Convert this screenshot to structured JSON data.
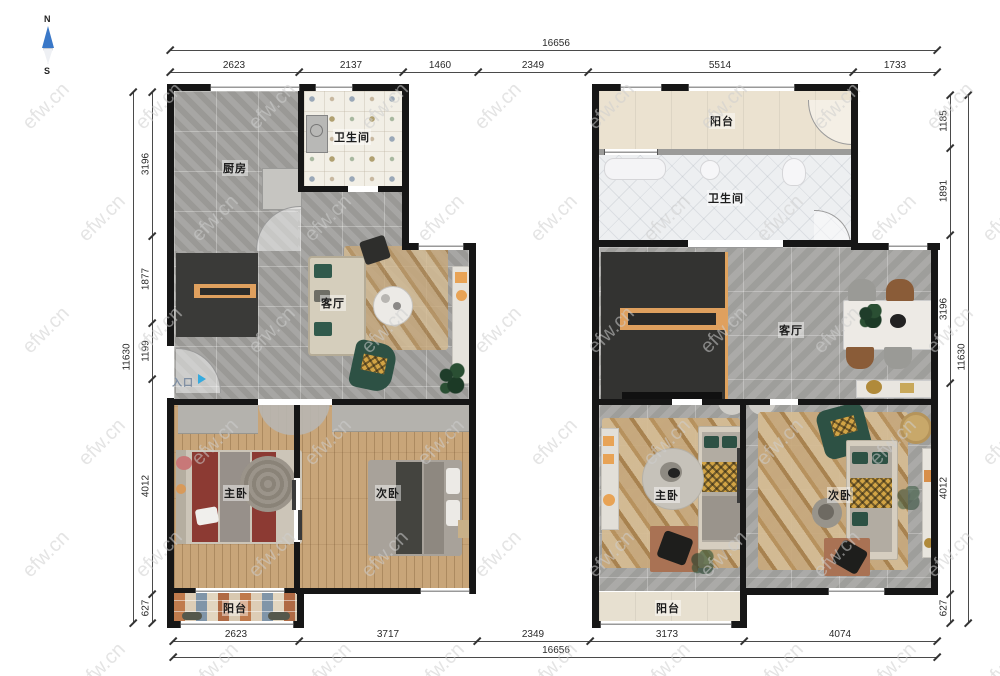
{
  "compass": {
    "north": "N",
    "south": "S"
  },
  "watermark": {
    "text": "efw.cn"
  },
  "floor1": {
    "kitchen_label": "厨房",
    "bath_label": "卫生间",
    "living_label": "客厅",
    "master_label": "主卧",
    "second_label": "次卧",
    "balcony_label": "阳台",
    "entrance_label": "入口"
  },
  "floor2": {
    "balcony_top_label": "阳台",
    "bath_label": "卫生间",
    "living_label": "客厅",
    "master_label": "主卧",
    "second_label": "次卧",
    "balcony_bottom_label": "阳台"
  },
  "dimensions": {
    "top": {
      "total": "16656",
      "segments": [
        "2623",
        "2137",
        "1460",
        "2349",
        "5514",
        "1733"
      ]
    },
    "bottom": {
      "total": "16656",
      "segments": [
        "2623",
        "3717",
        "2349",
        "3173",
        "4074"
      ]
    },
    "left": {
      "total": "11630",
      "segments": [
        "3196",
        "1877",
        "1199",
        "4012",
        "627"
      ]
    },
    "right": {
      "total": "11630",
      "segments": [
        "1185",
        "1891",
        "3196",
        "4012",
        "627"
      ]
    }
  },
  "colors": {
    "wall": "#161616",
    "accent_orange": "#e0a35e",
    "entrance_arrow": "#35aade",
    "north_arrow": "#3a78c8",
    "dimension_text": "#2a2a2a"
  }
}
